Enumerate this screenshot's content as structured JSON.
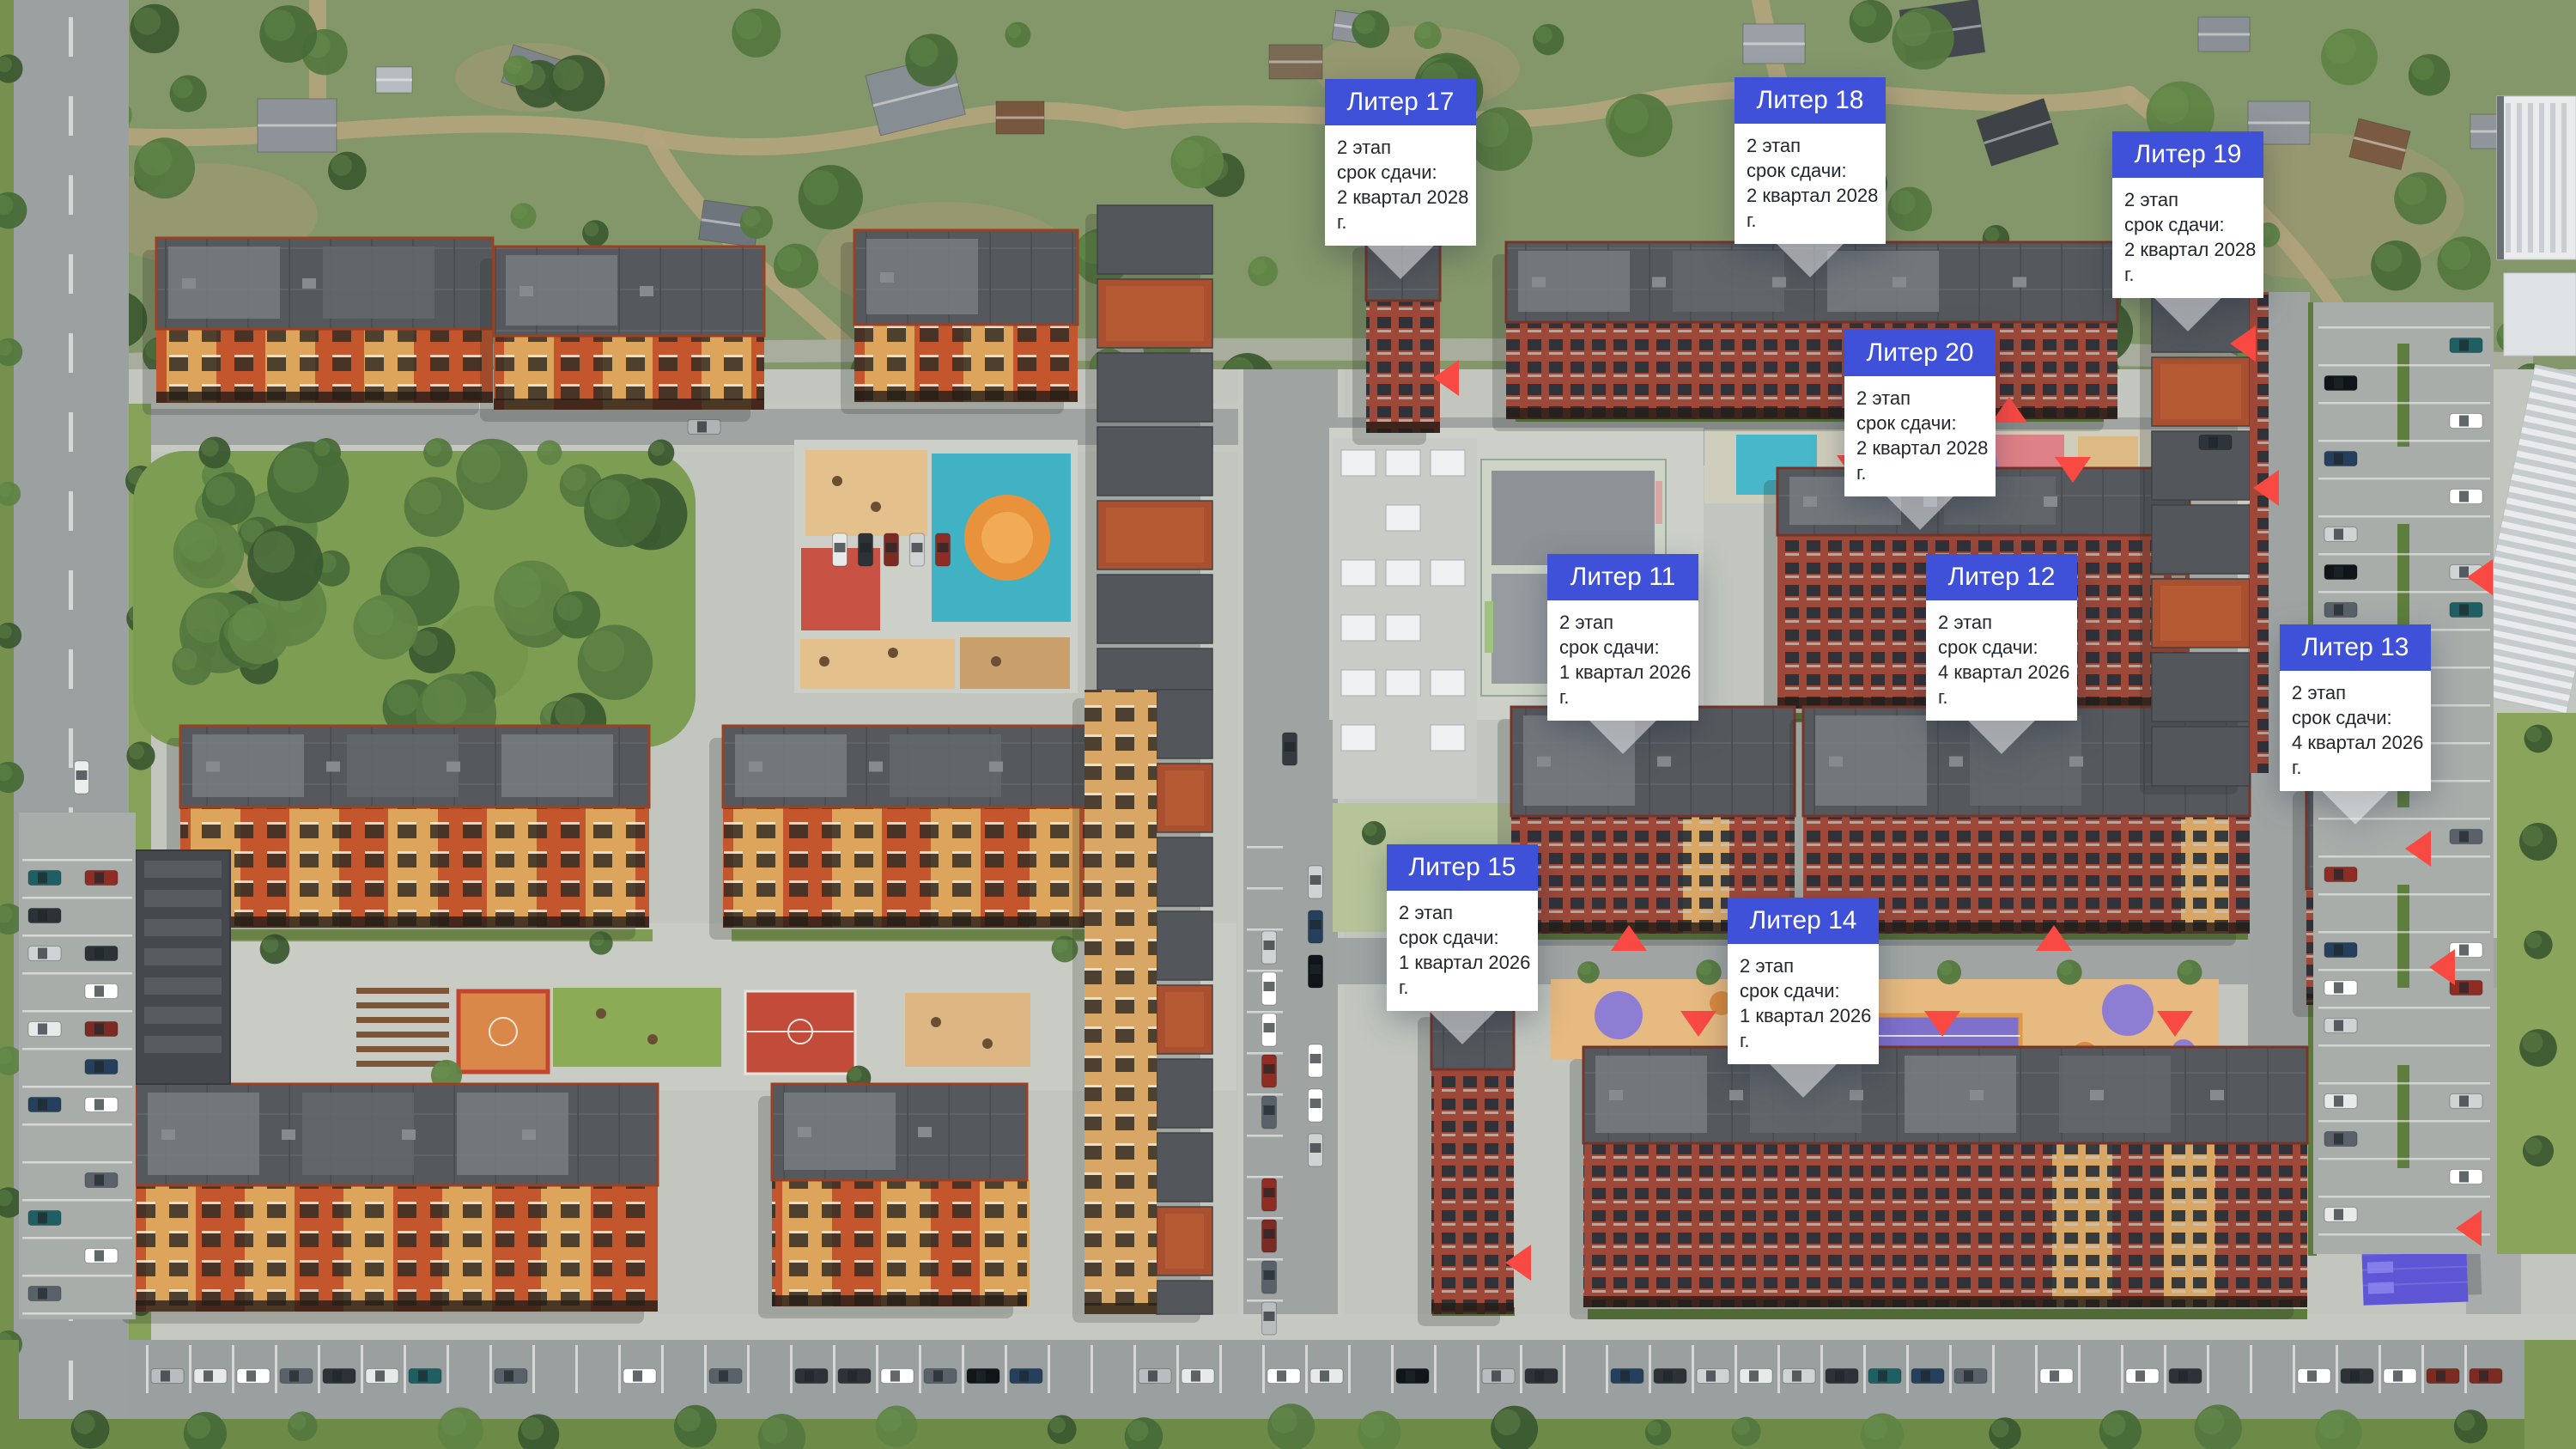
{
  "colors": {
    "accent": "#3f51d9",
    "marker": "#f84a42",
    "highlight": "#5e56d4",
    "highlight_roof": "#716ae2"
  },
  "callouts": [
    {
      "id": "liter-17",
      "name": "Литер 17",
      "stage": "2 этап",
      "deadline_label": "срок сдачи:",
      "deadline": "2 квартал 2028 г."
    },
    {
      "id": "liter-18",
      "name": "Литер 18",
      "stage": "2 этап",
      "deadline_label": "срок сдачи:",
      "deadline": "2 квартал 2028 г."
    },
    {
      "id": "liter-19",
      "name": "Литер 19",
      "stage": "2 этап",
      "deadline_label": "срок сдачи:",
      "deadline": "2 квартал 2028 г."
    },
    {
      "id": "liter-20",
      "name": "Литер 20",
      "stage": "2 этап",
      "deadline_label": "срок сдачи:",
      "deadline": "2 квартал 2028 г."
    },
    {
      "id": "liter-11",
      "name": "Литер 11",
      "stage": "2 этап",
      "deadline_label": "срок сдачи:",
      "deadline": "1 квартал 2026 г."
    },
    {
      "id": "liter-12",
      "name": "Литер 12",
      "stage": "2 этап",
      "deadline_label": "срок сдачи:",
      "deadline": "4 квартал 2026 г."
    },
    {
      "id": "liter-13",
      "name": "Литер 13",
      "stage": "2 этап",
      "deadline_label": "срок сдачи:",
      "deadline": "4 квартал 2026 г."
    },
    {
      "id": "liter-15",
      "name": "Литер 15",
      "stage": "2 этап",
      "deadline_label": "срок сдачи:",
      "deadline": "1 квартал 2026 г."
    },
    {
      "id": "liter-14",
      "name": "Литер 14",
      "stage": "2 этап",
      "deadline_label": "срок сдачи:",
      "deadline": "1 квартал 2026 г."
    }
  ]
}
